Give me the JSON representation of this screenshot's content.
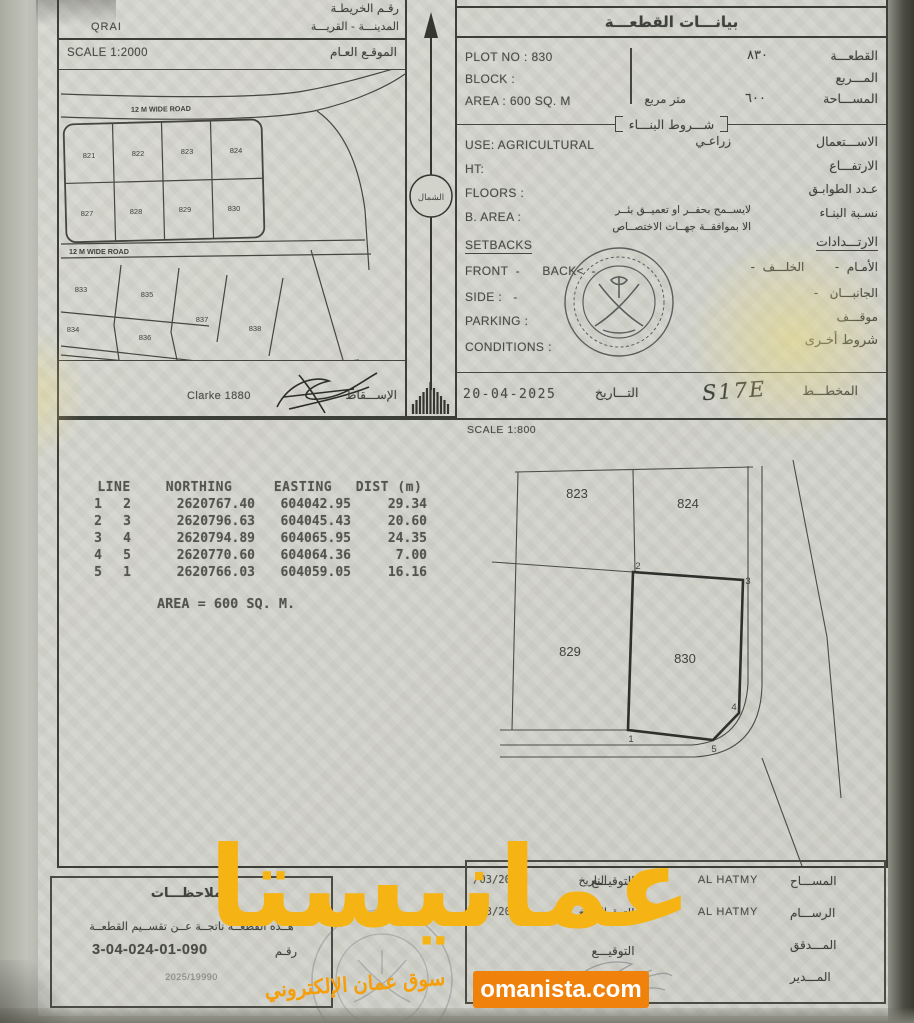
{
  "map_panel": {
    "map_no_label": "رقـم الخريطـة",
    "city_label": "المدينـــة - القريـــة",
    "city_value": "QRAI",
    "scale_label": "SCALE 1:2000",
    "location_label": "الموقـع العـام",
    "road_label": "12 M WIDE ROAD",
    "projection_value": "Clarke 1880",
    "projection_label": "الإســـقاط",
    "plots_row1": [
      "821",
      "822",
      "823",
      "824"
    ],
    "plots_row2": [
      "827",
      "828",
      "829",
      "830"
    ],
    "plots_lower": [
      "833",
      "835",
      "837",
      "838",
      "834",
      "836"
    ]
  },
  "north": {
    "label": "الشمال"
  },
  "info": {
    "title": "بيانـــات القطعـــة",
    "plot_en": "PLOT NO : 830",
    "plot_ar_value": "٨٣٠",
    "plot_ar_label": "القطعـــة",
    "block_en": "BLOCK :",
    "block_ar_label": "المـــربع",
    "area_en": "AREA : 600 SQ. M",
    "area_mid": "متر مربع",
    "area_ar_value": "٦٠٠",
    "area_ar_label": "المســـاحة",
    "conditions_title": "شـــروط البنـــاء",
    "use_en": "USE: AGRICULTURAL",
    "use_ar_value": "زراعـي",
    "use_ar_label": "الاســـتعمال",
    "ht_en": "HT:",
    "ht_ar_label": "الارتفـــاع",
    "floors_en": "FLOORS :",
    "floors_ar_label": "عـدد الطوابـق",
    "barea_en": "B. AREA :",
    "barea_ar_label": "نسـبة البنـاء",
    "note_line1": "لايســمح بحفــر او تعميــق بئــر",
    "note_line2": "الا بموافقــة جهــات الاختصــاص",
    "setbacks_en": "SETBACKS",
    "setbacks_ar_label": "الارتـــدادات",
    "frontback_en": "FRONT  -      BACK<  -",
    "frontback_ar": "الأمـام  -        الخلـــف  -",
    "side_en": "SIDE :   -",
    "side_ar": "الجانبـــان   -",
    "parking_en": "PARKING :",
    "parking_ar": "موقـــف",
    "conditions_en": "CONDITIONS :",
    "conditions_ar": "شروط أخـرى",
    "date_value": "20-04-2025",
    "date_label": "التـــاريخ",
    "plan_value": "S17E",
    "plan_label": "المخطـــط"
  },
  "survey": {
    "scale_label": "SCALE 1:800",
    "headers": [
      "LINE",
      "NORTHING",
      "EASTING",
      "DIST (m)"
    ],
    "rows": [
      [
        "1",
        "2",
        "2620767.40",
        "604042.95",
        "29.34"
      ],
      [
        "2",
        "3",
        "2620796.63",
        "604045.43",
        "20.60"
      ],
      [
        "3",
        "4",
        "2620794.89",
        "604065.95",
        "24.35"
      ],
      [
        "4",
        "5",
        "2620770.60",
        "604064.36",
        "7.00"
      ],
      [
        "5",
        "1",
        "2620766.03",
        "604059.05",
        "16.16"
      ]
    ],
    "area_note": "AREA = 600 SQ. M.",
    "plots": {
      "tl": "823",
      "tr": "824",
      "bl": "829",
      "br": "830"
    },
    "corners": [
      "1",
      "2",
      "3",
      "4",
      "5"
    ]
  },
  "notes": {
    "title": "الملاحظـــات",
    "line1": "هــذه القطعــة ناتجــة عــن تقســيم القطعــة",
    "num_label": "رقـم",
    "num_value": "3-04-024-01-090",
    "ref_value": "2025/19990"
  },
  "sigs": {
    "date_label": "التاريخ",
    "rows": [
      {
        "role": "المســـاح",
        "name": "AL HATMY",
        "sign": "التوقيـــع",
        "date": "/03/2025"
      },
      {
        "role": "الرســـام",
        "name": "AL HATMY",
        "sign": "التوقيـــع",
        "date": "/03/2025"
      },
      {
        "role": "المـــدقق",
        "name": "",
        "sign": "التوقيـــع",
        "date": ""
      },
      {
        "role": "المـــدير",
        "name": "",
        "sign": "",
        "date": ""
      }
    ]
  },
  "watermark": {
    "brand": "عمانيستا",
    "tagline": "سوق عمان الإلكتروني",
    "site": "omanista.com",
    "brand_color": "#f6b414",
    "button_color": "#f0810a"
  }
}
